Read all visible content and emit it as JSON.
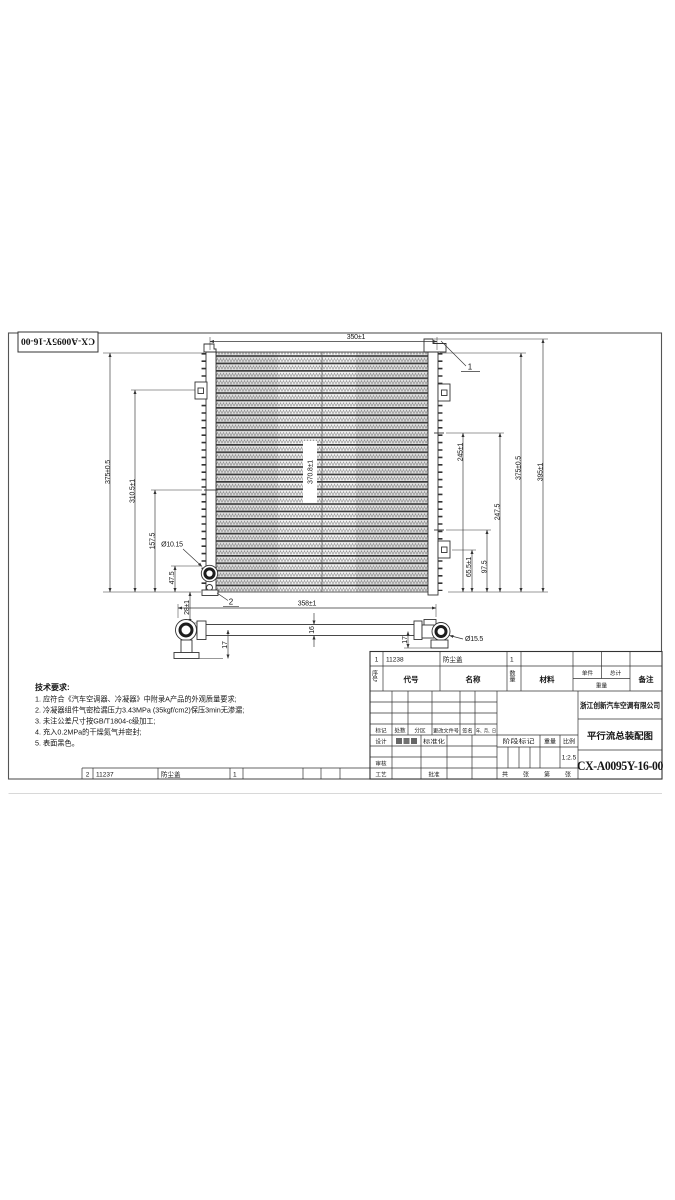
{
  "corner_label": "CX-A0095Y-16-00",
  "tech_requirements": {
    "title": "技术要求:",
    "items": [
      "1. 应符合《汽车空调器、冷凝器》中附录A产品的外观质量要求;",
      "2. 冷凝器组件气密检漏压力3.43MPa (35kgf/cm2)保压3min无渗漏;",
      "3. 未注公差尺寸按GB/T1804-c级加工;",
      "4. 充入0.2MPa的干燥氮气并密封;",
      "5. 表面黑色。"
    ]
  },
  "front_view": {
    "callouts": {
      "c1": "1",
      "c2": "2"
    },
    "dims": {
      "width_top": "350±1",
      "h375_left": "375±0.5",
      "h310": "310.5±1",
      "h157": "157.5",
      "h47": "47.5",
      "h28": "28±1",
      "hole_dia": "Ø10.15",
      "core_width": "370.8±1",
      "r245": "245±1",
      "r247": "247.5",
      "h375_right": "375±0.5",
      "r395": "395±1",
      "r65": "65.5±1",
      "r97": "97.5"
    }
  },
  "pipe_view": {
    "dims": {
      "length": "358±1",
      "height": "16",
      "left_drop": "17",
      "right_drop": "17",
      "end_dia": "Ø15.5"
    }
  },
  "parts_list": {
    "header": {
      "seq": "序号",
      "code": "代号",
      "name": "名称",
      "qty": "数量",
      "material": "材料",
      "unit": "单件",
      "total": "总计",
      "weight": "重量",
      "remark": "备注"
    },
    "rows": [
      {
        "seq": "1",
        "code": "11238",
        "name": "防尘盖",
        "qty": "1"
      },
      {
        "seq": "2",
        "code": "11237",
        "name": "防尘盖",
        "qty": "1"
      }
    ]
  },
  "title_block": {
    "company": "浙江创新汽车空调有限公司",
    "drawing_title": "平行流总装配图",
    "drawing_number": "CX-A0095Y-16-00",
    "scale_value": "1:2.5",
    "labels": {
      "mark": "标记",
      "count": "处数",
      "zone": "分区",
      "change_doc": "更改文件号",
      "sign": "签名",
      "date": "年、月、日",
      "design": "设计",
      "standardize": "标准化",
      "check": "审核",
      "process": "工艺",
      "approve": "批准",
      "stage_mark": "阶段标记",
      "weight": "重量",
      "scale": "比例",
      "sheet_total": "共",
      "sheet_zh1": "张",
      "sheet_no": "第",
      "sheet_zh2": "张"
    }
  }
}
